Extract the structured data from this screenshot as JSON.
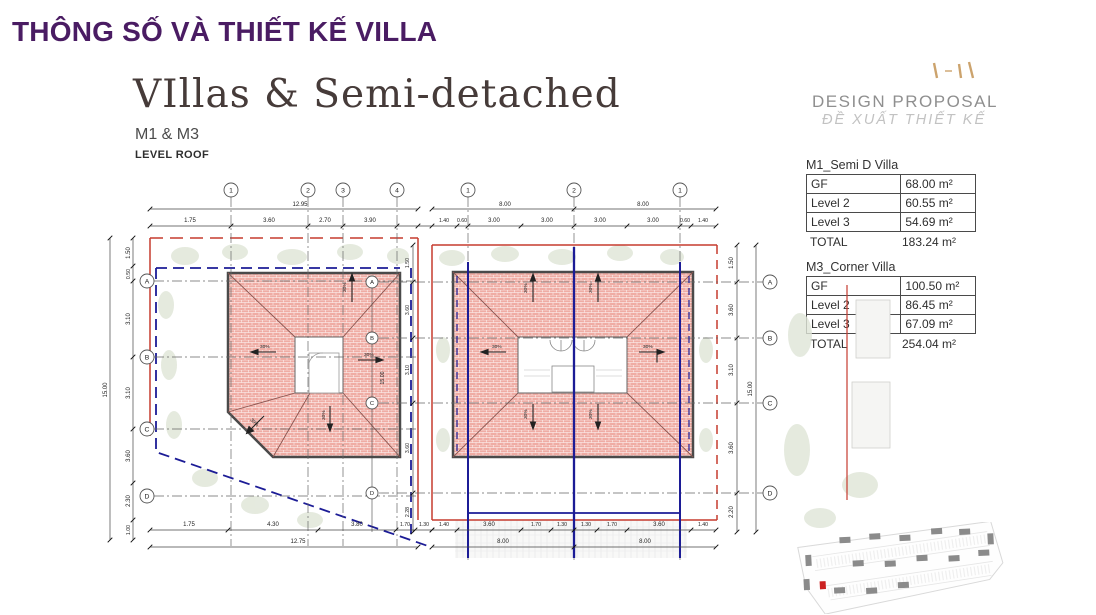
{
  "slide": {
    "title": "THÔNG SỐ VÀ THIẾT KẾ VILLA",
    "heading": "VIllas & Semi-detached",
    "model": "M1 & M3",
    "level": "LEVEL ROOF"
  },
  "proposal": {
    "title_en": "DESIGN PROPOSAL",
    "title_vi": "ĐỀ XUẤT THIẾT KẾ"
  },
  "tables": [
    {
      "title": "M1_Semi D Villa",
      "rows": [
        {
          "label": "GF",
          "value": "68.00 m²"
        },
        {
          "label": "Level 2",
          "value": "60.55 m²"
        },
        {
          "label": "Level 3",
          "value": "54.69 m²"
        }
      ],
      "total_label": "TOTAL",
      "total_value": "183.24 m²"
    },
    {
      "title": "M3_Corner Villa",
      "rows": [
        {
          "label": "GF",
          "value": "100.50 m²"
        },
        {
          "label": "Level 2",
          "value": "86.45 m²"
        },
        {
          "label": "Level 3",
          "value": "67.09 m²"
        }
      ],
      "total_label": "TOTAL",
      "total_value": "254.04 m²"
    }
  ],
  "drawing": {
    "slope": "30%",
    "left_plan": {
      "grid_top": [
        "1",
        "2",
        "3",
        "4"
      ],
      "grid_side": [
        "A",
        "B",
        "C",
        "D"
      ],
      "top_dims": [
        "1.75",
        "3.60",
        "2.70",
        "3.90"
      ],
      "top_total": "12.95",
      "bottom_dims": [
        "1.75",
        "4.30",
        "3.80",
        "1.70",
        "1.30"
      ],
      "bottom_total": "12.75",
      "side_dims": [
        "1.50",
        "0.50",
        "3.10",
        "3.10",
        "3.60",
        "2.30",
        "1.00"
      ],
      "side_total": "15.00"
    },
    "right_plan": {
      "grid_top": [
        "1",
        "2",
        "1"
      ],
      "grid_side": [
        "A",
        "B",
        "C",
        "D"
      ],
      "top_dims": [
        "1.40",
        "0.60",
        "3.00",
        "3.00",
        "3.00",
        "3.00",
        "0.60",
        "1.40"
      ],
      "top_totals": [
        "8.00",
        "8.00"
      ],
      "bottom_dims": [
        "1.40",
        "3.60",
        "1.70",
        "1.30",
        "1.30",
        "1.70",
        "3.60",
        "1.40"
      ],
      "bottom_totals": [
        "8.00",
        "8.00"
      ],
      "side_dims": [
        "1.50",
        "3.60",
        "3.10",
        "3.60",
        "2.20"
      ],
      "side_total": "15.00",
      "mid_dims": [
        "1.50",
        "3.60",
        "3.10",
        "3.60",
        "2.28"
      ],
      "mid_total": "15.00"
    }
  },
  "colors": {
    "accent_purple": "#4a1c63",
    "roof_fill": "#efaca4",
    "boundary_red": "#c63b2f",
    "boundary_blue": "#1c1c96",
    "logo_tan": "#c79a5e"
  }
}
